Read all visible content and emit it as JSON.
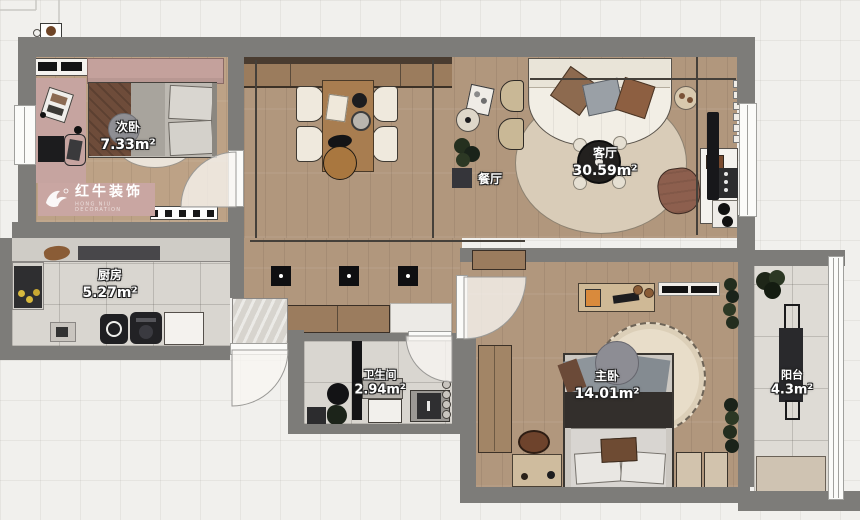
{
  "brand": {
    "name": "红牛装饰",
    "subtext": "HONG NIU DECORATION",
    "plate_color": "#c9a6a2"
  },
  "rooms": [
    {
      "id": "bedroom2",
      "name": "次卧",
      "area": "7.33m²"
    },
    {
      "id": "dining",
      "name": "餐厅",
      "area": ""
    },
    {
      "id": "living",
      "name": "客厅",
      "area": "30.59m²"
    },
    {
      "id": "kitchen",
      "name": "厨房",
      "area": "5.27m²"
    },
    {
      "id": "bathroom",
      "name": "卫生间",
      "area": "2.94m²"
    },
    {
      "id": "master",
      "name": "主卧",
      "area": "14.01m²"
    },
    {
      "id": "balcony",
      "name": "阳台",
      "area": "4.3m²"
    }
  ],
  "colors": {
    "wall": "#7d7c79",
    "wood_floor": "#b1977d",
    "tile_floor": "#d9d6d0",
    "accent_pink": "#c9a6a2",
    "label_text": "#ffffff",
    "label_outline": "#222222"
  }
}
